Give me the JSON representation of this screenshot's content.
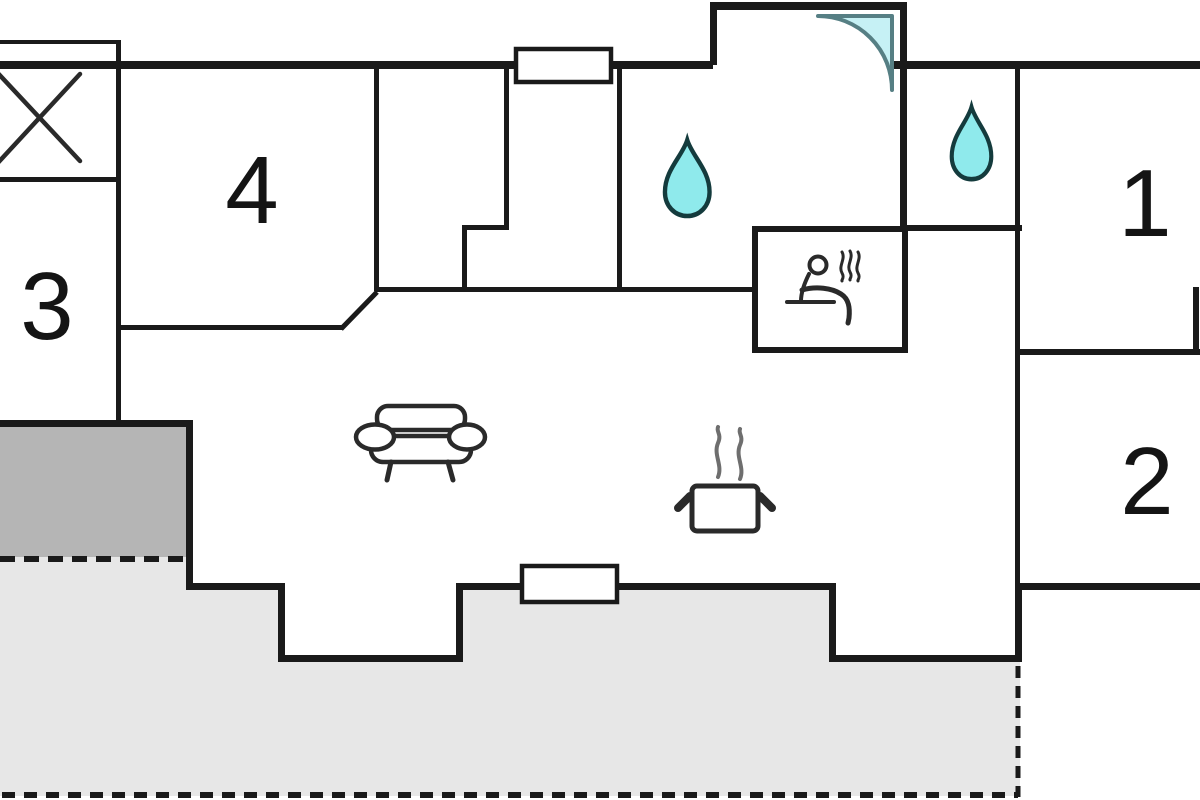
{
  "title": "Holiday home floor plan",
  "rooms": [
    {
      "id": "room-1",
      "label": "1"
    },
    {
      "id": "room-2",
      "label": "2"
    },
    {
      "id": "room-3",
      "label": "3"
    },
    {
      "id": "room-4",
      "label": "4"
    }
  ],
  "symbols": [
    {
      "name": "cross-box-icon",
      "meaning": "utility box with X"
    },
    {
      "name": "shower-corner-icon",
      "meaning": "corner shower cabin"
    },
    {
      "name": "water-drop-icon",
      "meaning": "bathroom water point",
      "count": 2
    },
    {
      "name": "sauna-icon",
      "meaning": "sauna (seated person with heat)"
    },
    {
      "name": "sofa-icon",
      "meaning": "living room sofa"
    },
    {
      "name": "cooking-pot-icon",
      "meaning": "kitchen stove pot"
    }
  ],
  "areas": [
    {
      "name": "terrace-covered",
      "style": "dark-gray"
    },
    {
      "name": "terrace-open",
      "style": "light-gray, dashed border"
    }
  ],
  "colors": {
    "wall": "#1a1a1a",
    "terrace_light": "#e7e7e7",
    "terrace_dark": "#b5b5b5",
    "water": "#8feaec",
    "water_outline": "#143b3d",
    "door": "#c6f1f5",
    "door_outline": "#567f84",
    "icon": "#2a2a2a",
    "background": "#ffffff"
  }
}
